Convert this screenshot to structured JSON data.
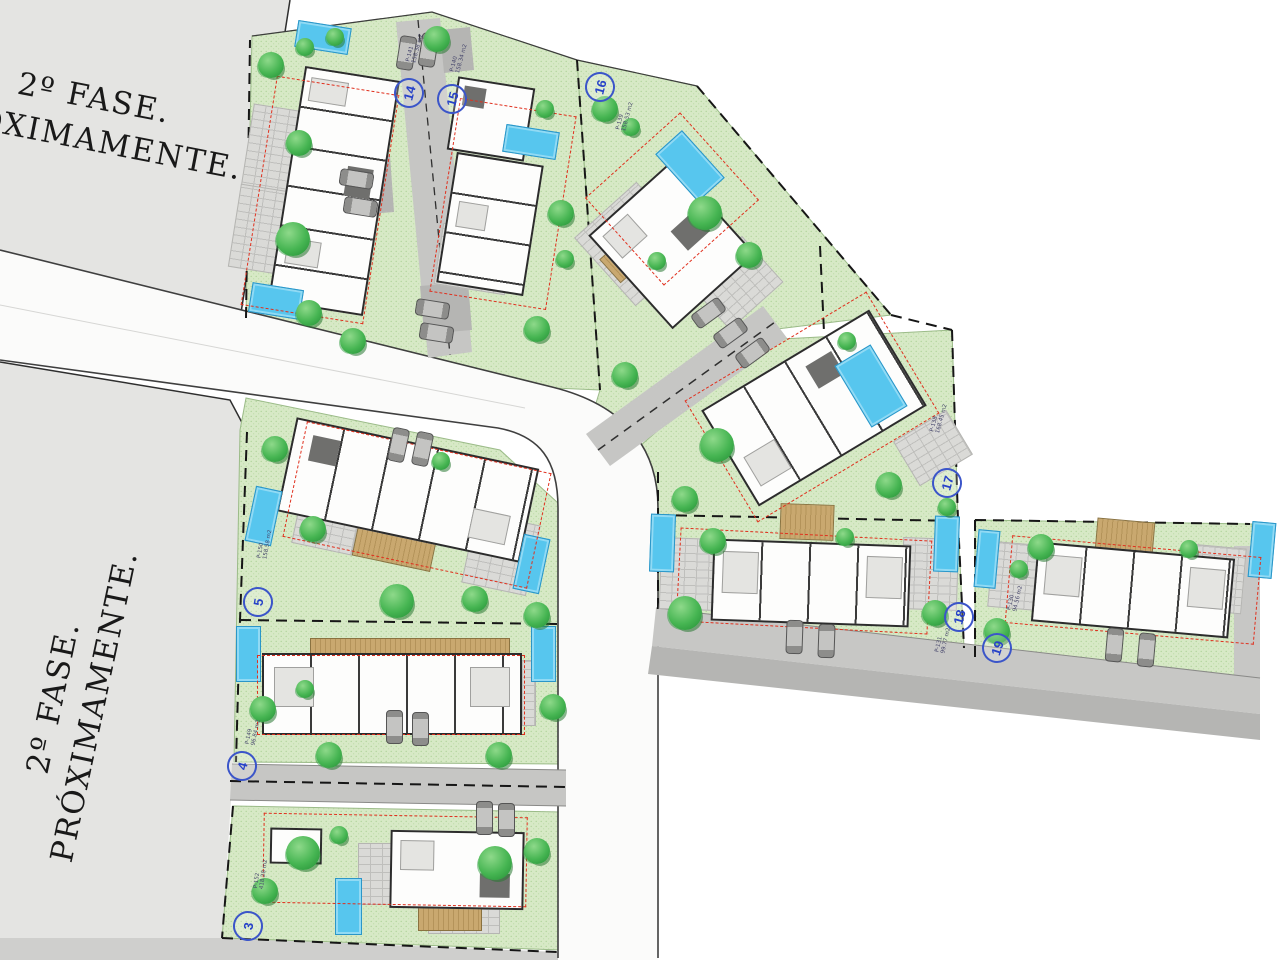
{
  "phase_notice": {
    "line1": "2º FASE.",
    "line2": "PRÓXIMAMENTE."
  },
  "plots": [
    {
      "number": "3",
      "parcel": "P-152",
      "area": "418.28 m2"
    },
    {
      "number": "4",
      "parcel": "P-149",
      "area": "96.84 m2"
    },
    {
      "number": "5",
      "parcel": "P-150",
      "area": "158.58 m2"
    },
    {
      "number": "14",
      "parcel": "P-141",
      "area": "158.38 m2"
    },
    {
      "number": "15",
      "parcel": "P-140",
      "area": "158.34 m2"
    },
    {
      "number": "16",
      "parcel": "P-139",
      "area": "158.53 m2"
    },
    {
      "number": "17",
      "parcel": "P-138",
      "area": "168.45 m2"
    },
    {
      "number": "18",
      "parcel": "P-131",
      "area": "99.77 m2"
    },
    {
      "number": "19",
      "parcel": "P-130",
      "area": "94.56 m2"
    }
  ],
  "colors": {
    "grass": "#d7e9c6",
    "phase_gray": "#e4e4e2",
    "road_white": "#fbfbfa",
    "road_gray": "#c7c7c5",
    "sidewalk_gray": "#b5b5b3",
    "pool_blue": "#57c6ee",
    "tree_green": "#46b552",
    "setback_red": "#e0301e",
    "badge_blue": "#2742c8",
    "boundary_black": "#161616"
  }
}
